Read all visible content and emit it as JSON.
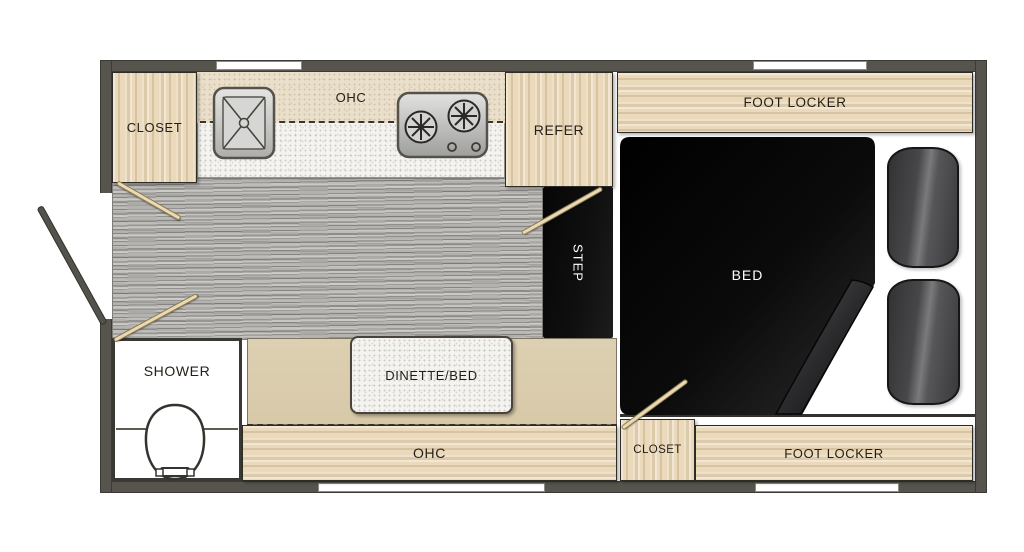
{
  "title": "Truck camper floor plan",
  "labels": {
    "closet_front": "CLOSET",
    "ohc_kitchen": "OHC",
    "refer": "REFER",
    "foot_locker_top": "FOOT LOCKER",
    "bed": "BED",
    "step": "STEP",
    "shower": "SHOWER",
    "dinette_bed": "DINETTE/BED",
    "ohc_bottom": "OHC",
    "closet_rear": "CLOSET",
    "foot_locker_bottom": "FOOT LOCKER"
  },
  "colors": {
    "wall": "#57544e",
    "wood": "#ead9bb",
    "counter_speckle": "#f4f3f0",
    "ohc_band": "#eadfca",
    "floor_gray": "#a8a7a4",
    "black_area": "#0a0a0a",
    "cushion_gray": "#4a4a4c",
    "dinette_tan": "#dbcdad",
    "swing_rod_tan": "#ead9b2",
    "window_white": "#ffffff",
    "label_dark": "#241e16",
    "label_light": "#ffffff"
  }
}
